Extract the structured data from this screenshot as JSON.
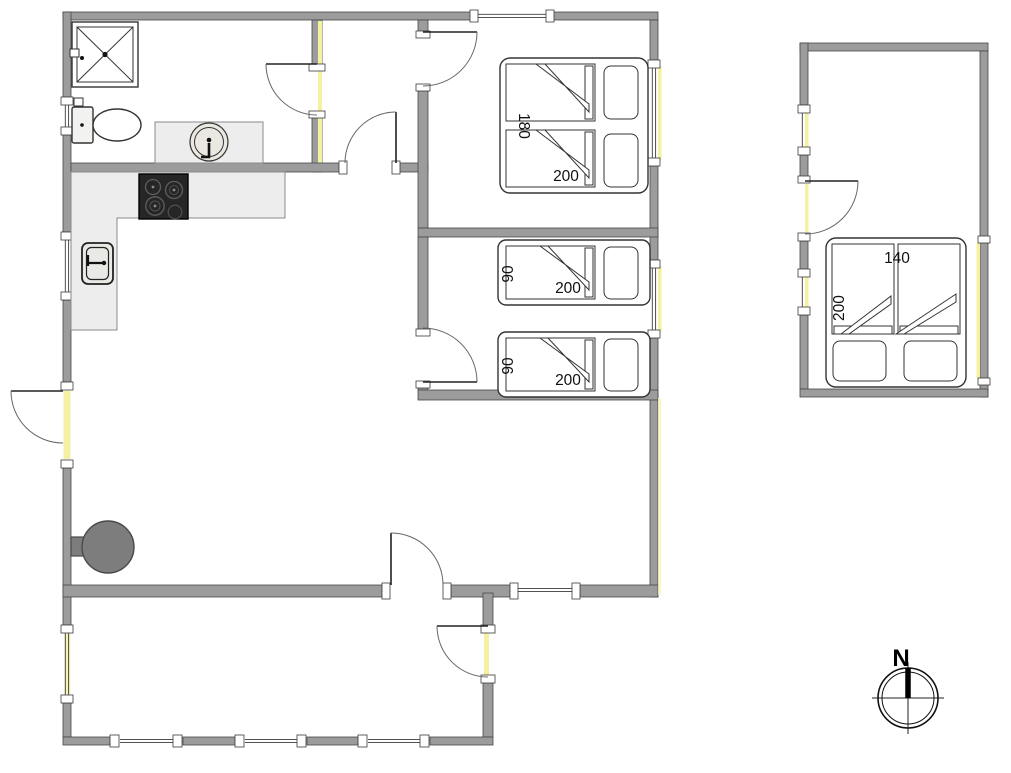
{
  "floorplan": {
    "main_house": {
      "bedroom1": {
        "bed": {
          "type": "double",
          "width_label": "180",
          "length_label": "200"
        }
      },
      "bedroom2": {
        "beds": [
          {
            "type": "single",
            "width_label": "90",
            "length_label": "200"
          },
          {
            "type": "single",
            "width_label": "90",
            "length_label": "200"
          }
        ]
      },
      "bathroom": {
        "fixtures": [
          "shower",
          "toilet",
          "washbasin"
        ]
      },
      "kitchen": {
        "fixtures": [
          "counter",
          "cooktop",
          "refrigerator"
        ]
      },
      "living_room": {
        "fixtures": [
          "wood-stove"
        ]
      },
      "entrance_hall": {
        "fixtures": []
      }
    },
    "annex": {
      "bed": {
        "type": "double",
        "width_label": "140",
        "length_label": "200"
      }
    },
    "compass": {
      "north_label": "N"
    },
    "colors": {
      "wall": "#9c9c9c",
      "wall_outline": "#474747",
      "window_highlight": "#f6f0a2",
      "counter": "#ededed",
      "cooktop": "#262626",
      "wood_stove": "#7d7d7d",
      "background": "#ffffff"
    }
  }
}
